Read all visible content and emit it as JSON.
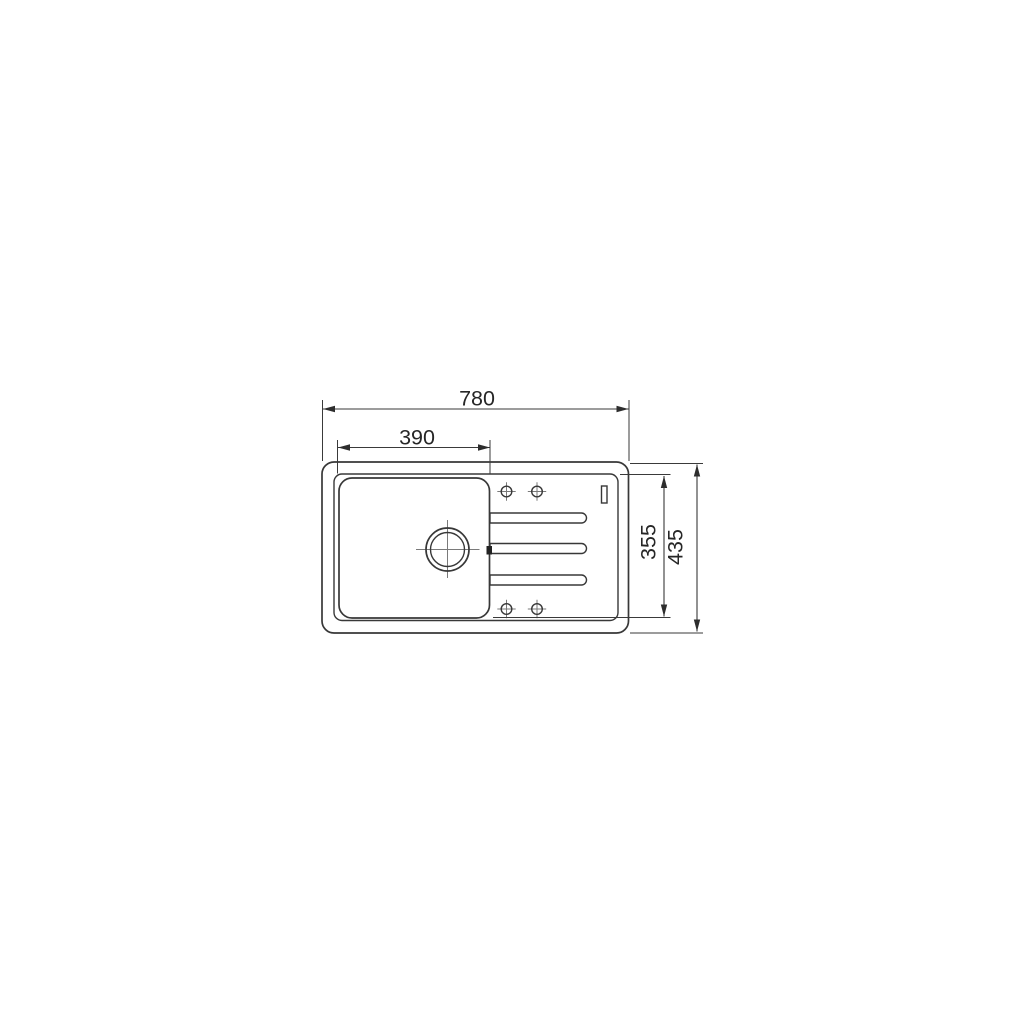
{
  "drawing": {
    "type": "technical-drawing",
    "subject": "inset kitchen sink with single bowl and drainer, top plan view",
    "dimensions": {
      "overall_width": "780",
      "bowl_width": "390",
      "inner_depth": "355",
      "overall_depth": "435"
    },
    "features": {
      "bowl_count": 1,
      "tap_holes": 4,
      "drainer_grooves": 3,
      "drain_outlet": 1,
      "overflow_slot": 1
    },
    "colors": {
      "line": "#383838",
      "centerline": "#7a7a7a",
      "text": "#262626",
      "background": "#ffffff"
    }
  }
}
